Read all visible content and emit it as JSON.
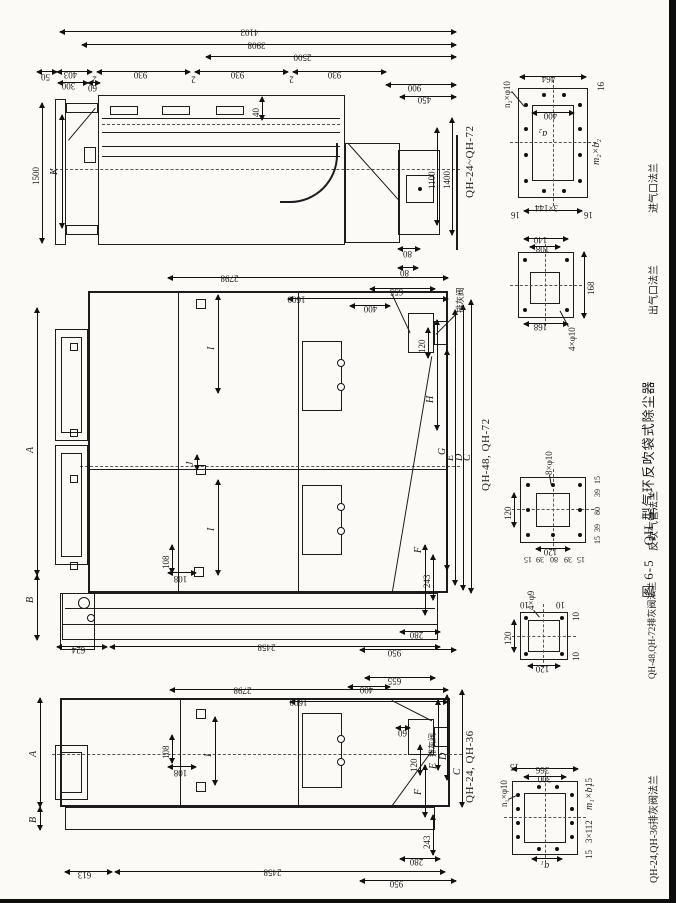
{
  "caption": "图 6-5　QH 型气环反吹袋式除尘器",
  "labels": {
    "view1": "QH-24, QH-36",
    "view2": "QH-48, QH-72",
    "view3": "QH-24~QH-72",
    "ash": "排灰阀",
    "inlet": "进气口法兰",
    "outlet": "出气口法兰",
    "blow": "反吹气管法兰",
    "ash48": "QH-48,QH-72排灰阀法兰",
    "ash24": "QH-24,QH-36排灰阀法兰"
  },
  "d": {
    "4103": "4103",
    "3908": "3908",
    "2500": "2500",
    "50": "50",
    "403": "403",
    "300": "300",
    "60": "60",
    "930": "930",
    "2": "2",
    "900": "900",
    "450": "450",
    "1500": "1500",
    "K": "K",
    "1100": "1100",
    "1400": "1400",
    "80": "80",
    "40": "40",
    "2798": "2798",
    "1600": "1600",
    "655": "655",
    "400": "400",
    "624": "624",
    "2458": "2458",
    "613": "613",
    "950": "950",
    "280": "280",
    "243": "243",
    "120": "120",
    "108": "108",
    "I": "I",
    "J": "J",
    "A": "A",
    "B": "B",
    "C": "C",
    "D": "D",
    "E": "E",
    "F": "F",
    "G": "G",
    "H": "H",
    "366": "366",
    "464": "464",
    "16": "16",
    "140": "140",
    "168": "168",
    "15": "15",
    "39": "39",
    "10": "10",
    "n2": "n₂×φ10",
    "a2": "a₂",
    "m2b2": "m₂×b₂",
    "p3x144": "3×144",
    "p4x10": "4×φ10",
    "p8x10": "8×φ10",
    "p4x9": "4×φ9",
    "n1": "n₁×φ10",
    "a1": "a₁",
    "m1b1": "m₁×b₁",
    "p3x112": "3×112"
  }
}
